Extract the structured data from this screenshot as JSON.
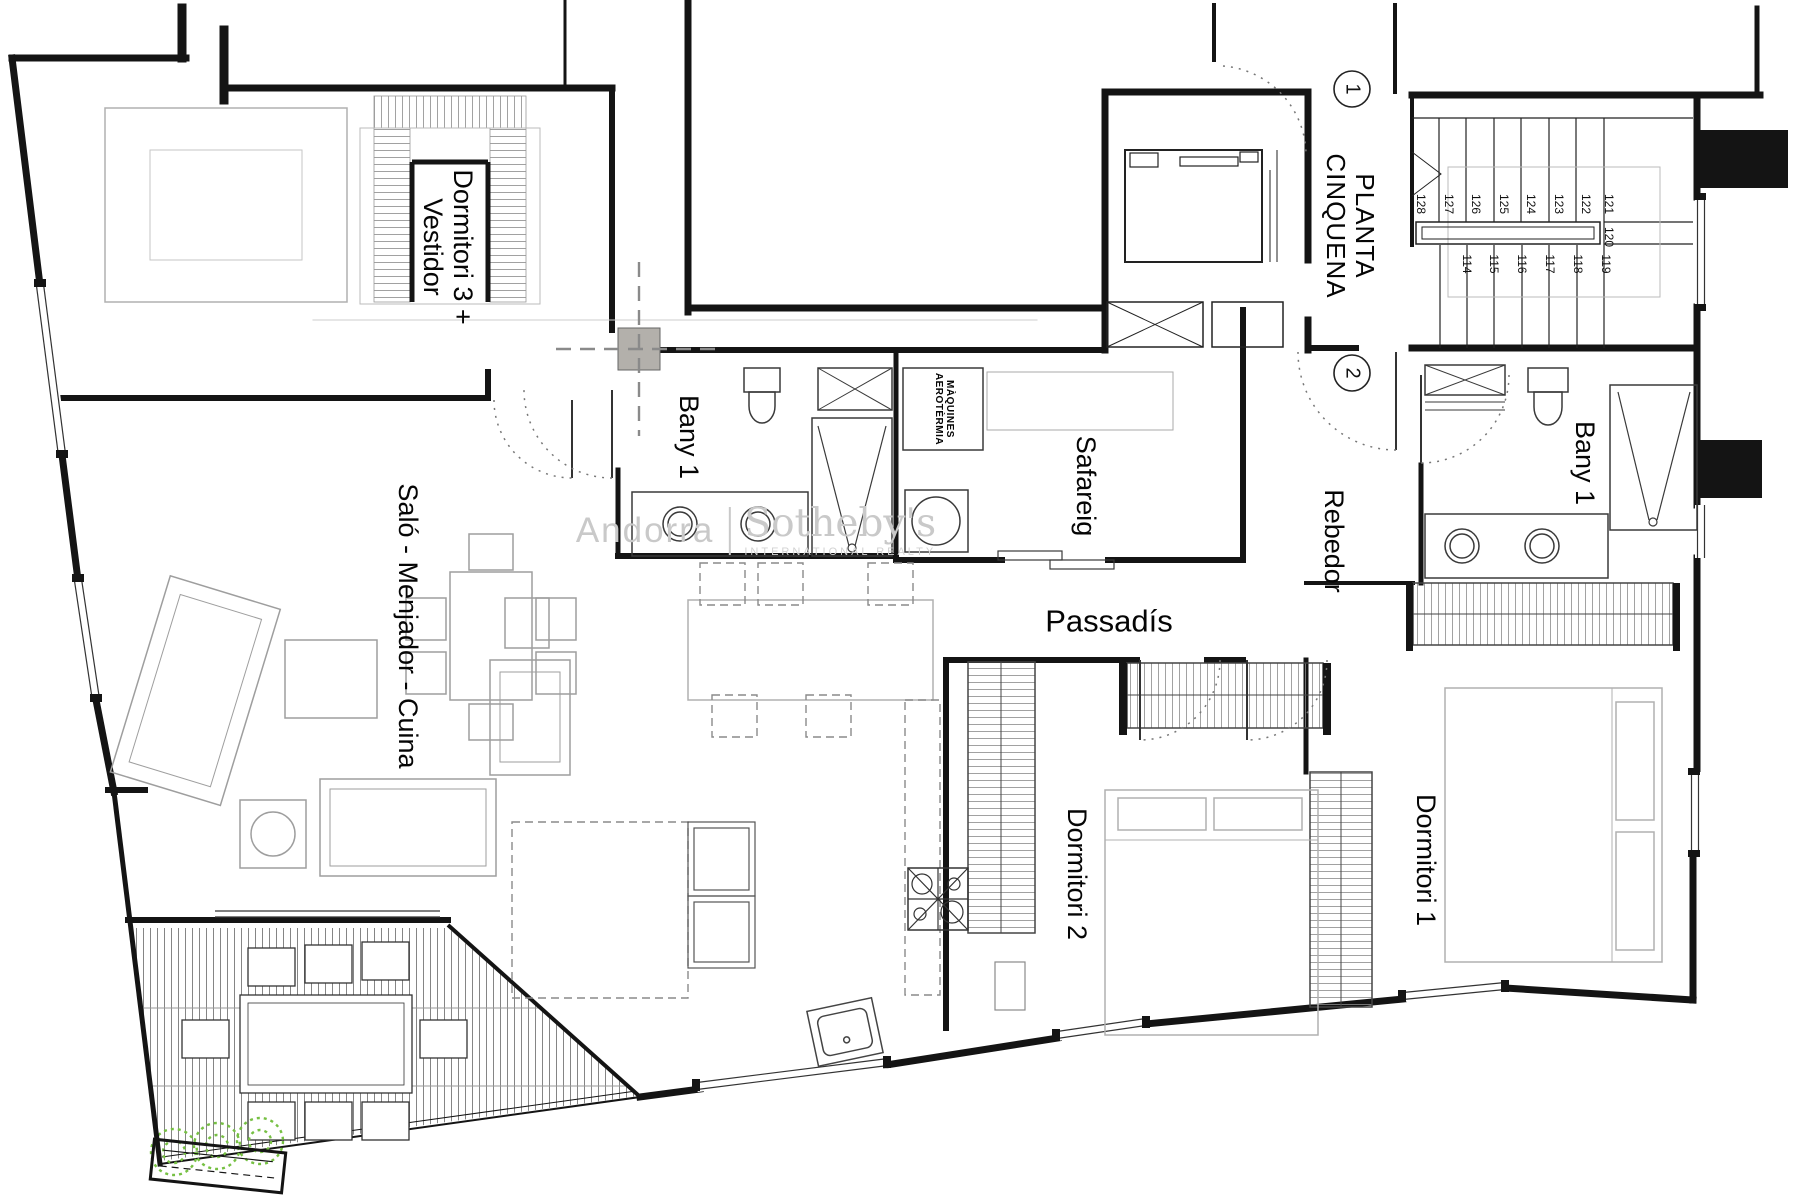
{
  "plan": {
    "floor_title": "PLANTA\nCINQUENA",
    "rooms": {
      "dormitori3": "Dormitori 3 +\nVestidor",
      "bany1_left": "Bany 1",
      "safareig": "Safareig",
      "rebedor": "Rebedor",
      "bany1_right": "Bany 1",
      "passadis": "Passadís",
      "dormitori2": "Dormitori 2",
      "dormitori1": "Dormitori 1",
      "salo_menjador_cuina": "Saló - Menjador - Cuina",
      "maquines": "MÀQUINES\nAEROTÈRMIA"
    },
    "section_markers": {
      "one": "1",
      "two": "2"
    },
    "stairs": {
      "steps": [
        "128",
        "127",
        "126",
        "125",
        "124",
        "123",
        "122",
        "121",
        "120",
        "119",
        "118",
        "117",
        "116",
        "115",
        "114"
      ]
    },
    "colors": {
      "wall": "#141414",
      "furniture": "#a0a0a0",
      "watermark": "#c9c9c9",
      "planter_green": "#76c043",
      "section_square": "#b3b0ab"
    }
  },
  "watermark": {
    "brand_left": "Andorra",
    "brand_right": "Sotheby's",
    "brand_sub": "INTERNATIONAL REALTY"
  }
}
